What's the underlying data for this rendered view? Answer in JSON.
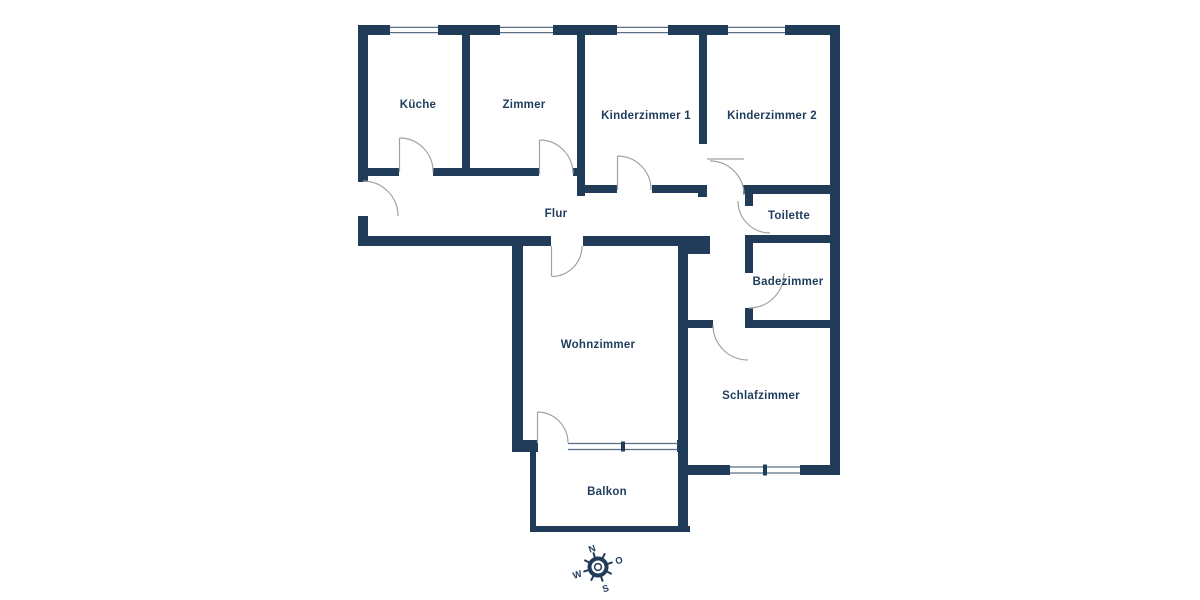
{
  "rooms": {
    "kueche": "Küche",
    "zimmer": "Zimmer",
    "kinderzimmer1": "Kinderzimmer 1",
    "kinderzimmer2": "Kinderzimmer 2",
    "flur": "Flur",
    "toilette": "Toilette",
    "badezimmer": "Badezimmer",
    "wohnzimmer": "Wohnzimmer",
    "schlafzimmer": "Schlafzimmer",
    "balkon": "Balkon"
  },
  "compass": {
    "n": "N",
    "o": "O",
    "s": "S",
    "w": "W"
  },
  "colors": {
    "wall": "#203c59",
    "text": "#1f3d5c",
    "door": "#9fa3a7",
    "win": "#5a6f85",
    "bg": "#ffffff"
  }
}
